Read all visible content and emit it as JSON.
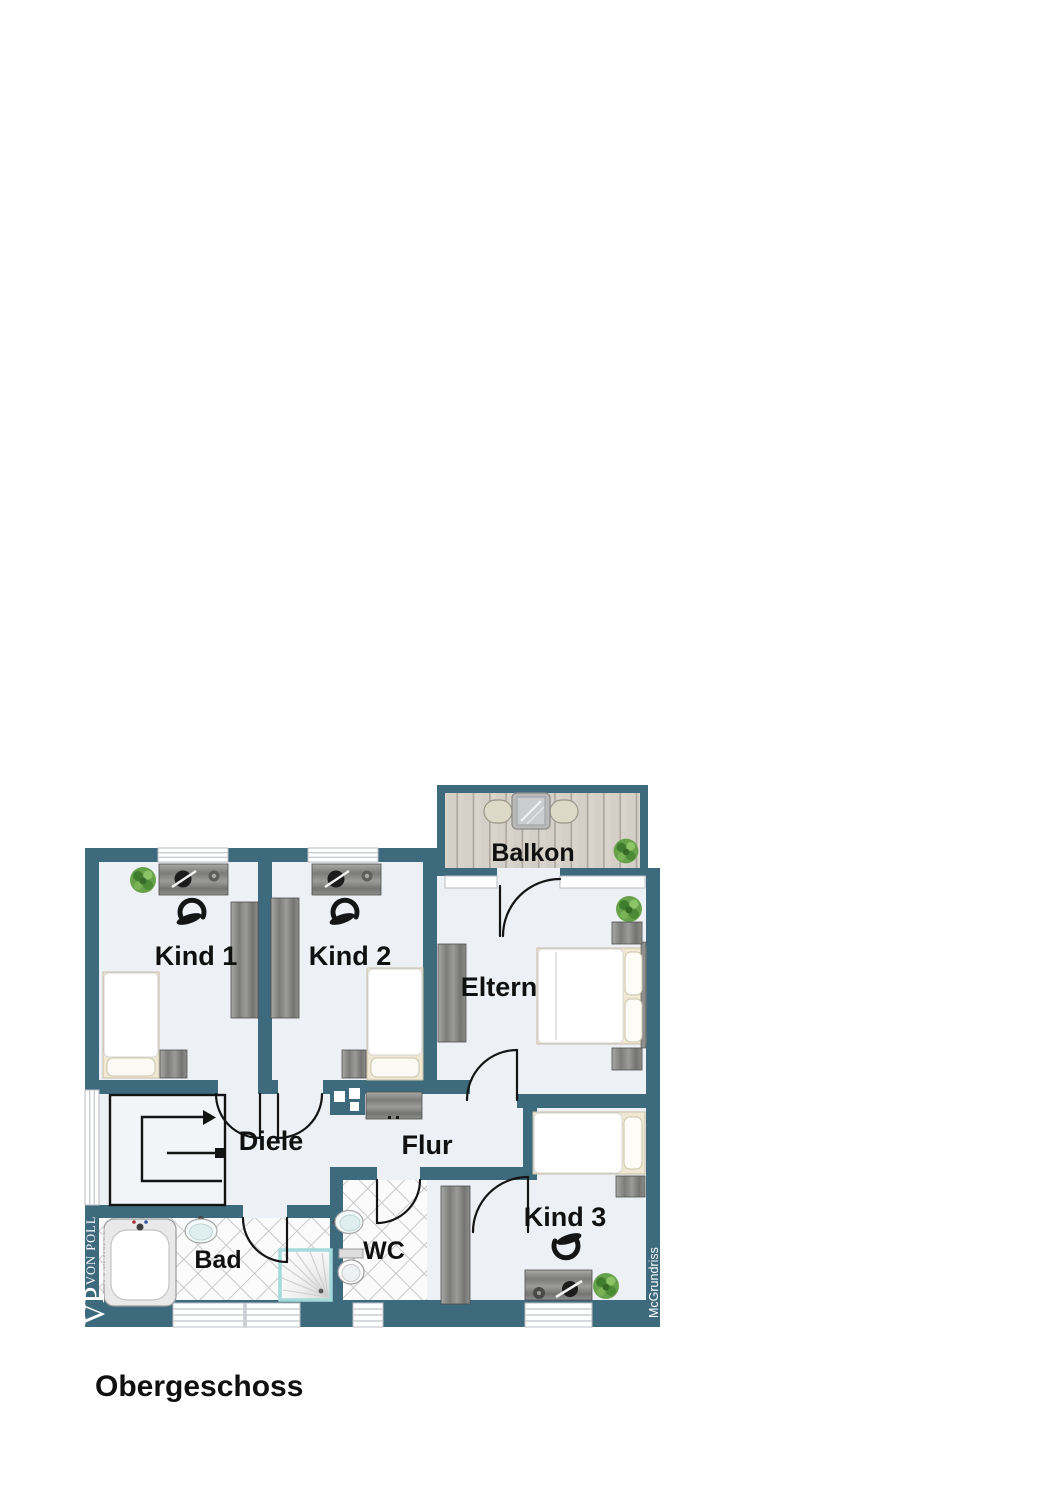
{
  "title": "Obergeschoss",
  "watermark": "McGrundriss",
  "branding": {
    "monogram": "VP",
    "name": "VON POLL",
    "subtitle": "IMMOBILIEN®"
  },
  "rooms": {
    "kind1": {
      "label": "Kind 1"
    },
    "kind2": {
      "label": "Kind 2"
    },
    "eltern": {
      "label": "Eltern"
    },
    "balkon": {
      "label": "Balkon"
    },
    "diele": {
      "label": "Diele"
    },
    "flur": {
      "label": "Flur"
    },
    "bad": {
      "label": "Bad"
    },
    "wc": {
      "label": "WC"
    },
    "kind3": {
      "label": "Kind 3"
    }
  },
  "colors": {
    "wall": "#3D6A7C",
    "floor": "#EDF0F4",
    "balcony_wood": "#D8D3CB",
    "shower_accent": "#A5DADA",
    "plant": "#67A24B",
    "label_text": "#101010",
    "logo_text": "#FFFFFF"
  }
}
